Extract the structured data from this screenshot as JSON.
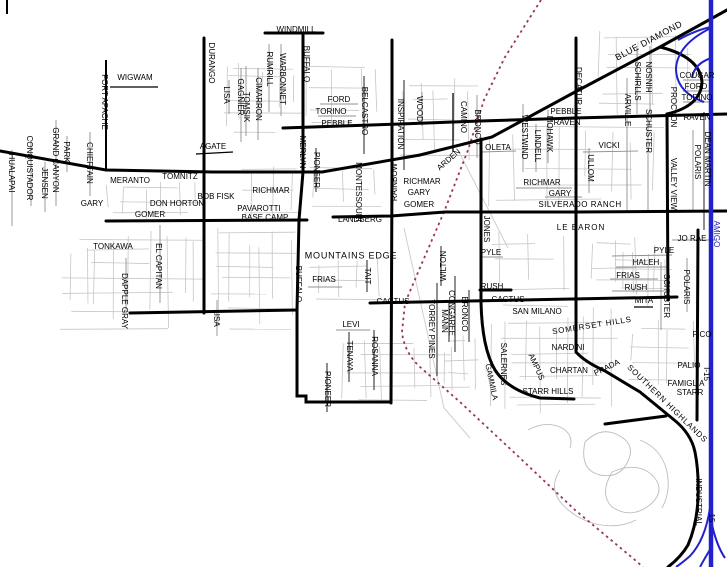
{
  "map": {
    "region": "Enterprise / Silverado Ranch, Las Vegas NV area street map",
    "colors": {
      "freeway": "#2222cc",
      "railroad": "#993366",
      "arterial": "#000000",
      "local": "#c6c6c6",
      "collector": "#909090",
      "label": "#000000",
      "freeway_label": "#2222bb"
    },
    "labels": [
      {
        "t": "HUALAPAI",
        "x": 11,
        "y": 173,
        "r": 90
      },
      {
        "t": "CONQUISTADOR",
        "x": 29,
        "y": 168,
        "r": 90
      },
      {
        "t": "JENSEN",
        "x": 44,
        "y": 183,
        "r": 90
      },
      {
        "t": "GRAND CANYON",
        "x": 55,
        "y": 160,
        "r": 90
      },
      {
        "t": "PARK",
        "x": 66,
        "y": 152,
        "r": 90
      },
      {
        "t": "CHIEFTAIN",
        "x": 89,
        "y": 163,
        "r": 90
      },
      {
        "t": "FORT APACHE",
        "x": 104,
        "y": 102,
        "r": 90
      },
      {
        "t": "WIGWAM",
        "x": 135,
        "y": 78,
        "r": 0
      },
      {
        "t": "DURANGO",
        "x": 211,
        "y": 63,
        "r": 90
      },
      {
        "t": "LISA",
        "x": 226,
        "y": 95,
        "r": 90
      },
      {
        "t": "GAGNIER",
        "x": 240,
        "y": 97,
        "r": 90
      },
      {
        "t": "AGATE",
        "x": 213,
        "y": 147,
        "r": 0
      },
      {
        "t": "MERANTO",
        "x": 130,
        "y": 181,
        "r": 0
      },
      {
        "t": "TOMNITZ",
        "x": 180,
        "y": 177,
        "r": 0
      },
      {
        "t": "GARY",
        "x": 92,
        "y": 204,
        "r": 0
      },
      {
        "t": "DON HORTON",
        "x": 177,
        "y": 204,
        "r": 0
      },
      {
        "t": "BOB FISK",
        "x": 216,
        "y": 197,
        "r": 0
      },
      {
        "t": "GOMER",
        "x": 150,
        "y": 215,
        "r": 0
      },
      {
        "t": "PAVAROTTI",
        "x": 259,
        "y": 209,
        "r": 0
      },
      {
        "t": "BASE CAMP",
        "x": 265,
        "y": 218,
        "r": 0
      },
      {
        "t": "TONKAWA",
        "x": 113,
        "y": 247,
        "r": 0
      },
      {
        "t": "EL CAPITAN",
        "x": 158,
        "y": 266,
        "r": 90
      },
      {
        "t": "DAPPLE GRAY",
        "x": 124,
        "y": 301,
        "r": 90
      },
      {
        "t": "LISA",
        "x": 216,
        "y": 318,
        "r": 90
      },
      {
        "t": "WINDMILL",
        "x": 296,
        "y": 30,
        "r": 0
      },
      {
        "t": "BUFFALO",
        "x": 306,
        "y": 64,
        "r": 90
      },
      {
        "t": "WARBONNET",
        "x": 282,
        "y": 79,
        "r": 90
      },
      {
        "t": "RUMRILL",
        "x": 269,
        "y": 69,
        "r": 90
      },
      {
        "t": "CIMARRON",
        "x": 258,
        "y": 99,
        "r": 90
      },
      {
        "t": "TOMSIK",
        "x": 246,
        "y": 107,
        "r": 90
      },
      {
        "t": "FORD",
        "x": 339,
        "y": 100,
        "r": 0
      },
      {
        "t": "TORINO",
        "x": 331,
        "y": 112,
        "r": 0
      },
      {
        "t": "PEBBLE",
        "x": 337,
        "y": 124,
        "r": 0
      },
      {
        "t": "BELCASTRO",
        "x": 364,
        "y": 111,
        "r": 90
      },
      {
        "t": "MERLYN",
        "x": 302,
        "y": 152,
        "r": 90
      },
      {
        "t": "PIONEER",
        "x": 316,
        "y": 170,
        "r": 90
      },
      {
        "t": "MONTESSOURI",
        "x": 358,
        "y": 192,
        "r": 90
      },
      {
        "t": "INSPIRATION",
        "x": 400,
        "y": 124,
        "r": 90
      },
      {
        "t": "WOOD",
        "x": 419,
        "y": 109,
        "r": 90
      },
      {
        "t": "CAMINO",
        "x": 463,
        "y": 117,
        "r": 90
      },
      {
        "t": "BRONCO",
        "x": 477,
        "y": 127,
        "r": 90
      },
      {
        "t": "ARDEN",
        "x": 449,
        "y": 160,
        "r": -41
      },
      {
        "t": "RICHMAR",
        "x": 271,
        "y": 191,
        "r": 0
      },
      {
        "t": "RICHMAR",
        "x": 422,
        "y": 182,
        "r": 0
      },
      {
        "t": "GARY",
        "x": 419,
        "y": 193,
        "r": 0
      },
      {
        "t": "GOMER",
        "x": 419,
        "y": 205,
        "r": 0
      },
      {
        "t": "RAINBOW",
        "x": 395,
        "y": 182,
        "r": -90
      },
      {
        "t": "LANDBERG",
        "x": 360,
        "y": 220,
        "r": 0
      },
      {
        "t": "MOUNTAINS EDGE",
        "x": 351,
        "y": 256,
        "r": 0,
        "fs": 9,
        "ls": 0.8
      },
      {
        "t": "BUFFALO",
        "x": 298,
        "y": 284,
        "r": 90
      },
      {
        "t": "FRIAS",
        "x": 324,
        "y": 280,
        "r": 0
      },
      {
        "t": "TAIT",
        "x": 367,
        "y": 276,
        "r": 90
      },
      {
        "t": "CACTUS",
        "x": 393,
        "y": 302,
        "r": 0
      },
      {
        "t": "LEVI",
        "x": 351,
        "y": 325,
        "r": 0
      },
      {
        "t": "TENAYA",
        "x": 349,
        "y": 356,
        "r": 90
      },
      {
        "t": "ROSANNA",
        "x": 374,
        "y": 356,
        "r": 90
      },
      {
        "t": "PIONEER",
        "x": 327,
        "y": 389,
        "r": 90
      },
      {
        "t": "BLUE DIAMOND",
        "x": 649,
        "y": 41,
        "r": -28,
        "fs": 9,
        "ls": 0.5
      },
      {
        "t": "DECATUR",
        "x": 578,
        "y": 86,
        "r": 90
      },
      {
        "t": "SCHIRLLS",
        "x": 637,
        "y": 81,
        "r": 90
      },
      {
        "t": "HINSON",
        "x": 650,
        "y": 77,
        "r": -90
      },
      {
        "t": "SCHUSTER",
        "x": 648,
        "y": 131,
        "r": 90
      },
      {
        "t": "ARVILLE",
        "x": 627,
        "y": 110,
        "r": 90
      },
      {
        "t": "PROCYON",
        "x": 673,
        "y": 107,
        "r": 90
      },
      {
        "t": "COUGAR",
        "x": 697,
        "y": 76,
        "r": 0
      },
      {
        "t": "FORD",
        "x": 696,
        "y": 87,
        "r": 0
      },
      {
        "t": "TORINO",
        "x": 697,
        "y": 98,
        "r": 0
      },
      {
        "t": "RAVEN",
        "x": 697,
        "y": 118,
        "r": 0
      },
      {
        "t": "PEBBLE",
        "x": 566,
        "y": 112,
        "r": 0
      },
      {
        "t": "RAVEN",
        "x": 567,
        "y": 123,
        "r": 0
      },
      {
        "t": "MOHAWK",
        "x": 549,
        "y": 134,
        "r": 90
      },
      {
        "t": "WESTWIND",
        "x": 524,
        "y": 137,
        "r": 90
      },
      {
        "t": "LINDELL",
        "x": 537,
        "y": 146,
        "r": 90
      },
      {
        "t": "OLETA",
        "x": 498,
        "y": 148,
        "r": 0
      },
      {
        "t": "VICKI",
        "x": 609,
        "y": 146,
        "r": 0
      },
      {
        "t": "ULLOM",
        "x": 590,
        "y": 168,
        "r": 90
      },
      {
        "t": "RICHMAR",
        "x": 542,
        "y": 183,
        "r": 0
      },
      {
        "t": "GARY",
        "x": 560,
        "y": 194,
        "r": 0
      },
      {
        "t": "SILVERADO RANCH",
        "x": 580,
        "y": 205,
        "r": 0,
        "ls": 0.5
      },
      {
        "t": "JONES",
        "x": 486,
        "y": 229,
        "r": 90
      },
      {
        "t": "LE BARON",
        "x": 581,
        "y": 228,
        "r": 0,
        "ls": 1
      },
      {
        "t": "JO RAE",
        "x": 692,
        "y": 239,
        "r": 0
      },
      {
        "t": "PYLE",
        "x": 664,
        "y": 251,
        "r": 0
      },
      {
        "t": "HALEH",
        "x": 646,
        "y": 263,
        "r": 0
      },
      {
        "t": "FRIAS",
        "x": 628,
        "y": 276,
        "r": 0
      },
      {
        "t": "RUSH",
        "x": 636,
        "y": 288,
        "r": 0
      },
      {
        "t": "MITA",
        "x": 644,
        "y": 301,
        "r": 0
      },
      {
        "t": "SCHUSTER",
        "x": 666,
        "y": 296,
        "r": 90
      },
      {
        "t": "POLARIS",
        "x": 686,
        "y": 287,
        "r": 90
      },
      {
        "t": "PYLE",
        "x": 491,
        "y": 253,
        "r": 0
      },
      {
        "t": "RUSH",
        "x": 492,
        "y": 287,
        "r": 0
      },
      {
        "t": "CACTUS",
        "x": 508,
        "y": 300,
        "r": 0
      },
      {
        "t": "SAN MILANO",
        "x": 537,
        "y": 312,
        "r": 0
      },
      {
        "t": "SOMERSET HILLS",
        "x": 592,
        "y": 326,
        "r": -9,
        "ls": 0.8
      },
      {
        "t": "FICO",
        "x": 702,
        "y": 335,
        "r": 0
      },
      {
        "t": "VALLEY VIEW",
        "x": 673,
        "y": 184,
        "r": 90
      },
      {
        "t": "DEAN MARTIN",
        "x": 707,
        "y": 159,
        "r": 90
      },
      {
        "t": "POLARIS",
        "x": 697,
        "y": 162,
        "r": 90
      },
      {
        "t": "WILTON",
        "x": 444,
        "y": 266,
        "r": -90
      },
      {
        "t": "CONGAREE",
        "x": 451,
        "y": 313,
        "r": 90
      },
      {
        "t": "MANN",
        "x": 444,
        "y": 321,
        "r": 90
      },
      {
        "t": "TORREY PINES",
        "x": 431,
        "y": 329,
        "r": 90
      },
      {
        "t": "BRONCO",
        "x": 464,
        "y": 314,
        "r": 90
      },
      {
        "t": "NARDINI",
        "x": 568,
        "y": 348,
        "r": 0
      },
      {
        "t": "CHARTAN",
        "x": 569,
        "y": 371,
        "r": 0
      },
      {
        "t": "PRADA",
        "x": 607,
        "y": 368,
        "r": -26
      },
      {
        "t": "SOUTHERN HIGHLANDS",
        "x": 667,
        "y": 404,
        "r": 44,
        "ls": 0.8
      },
      {
        "t": "FAMIGLIA",
        "x": 686,
        "y": 384,
        "r": 0
      },
      {
        "t": "STARR",
        "x": 690,
        "y": 393,
        "r": 0
      },
      {
        "t": "PALIO",
        "x": 689,
        "y": 366,
        "r": 0
      },
      {
        "t": "STARR HILLS",
        "x": 548,
        "y": 392,
        "r": 0
      },
      {
        "t": "SALERNES",
        "x": 503,
        "y": 364,
        "r": 90
      },
      {
        "t": "GAMMILA",
        "x": 491,
        "y": 382,
        "r": 78
      },
      {
        "t": "AMPUS",
        "x": 536,
        "y": 367,
        "r": 66
      },
      {
        "t": "INDUSTRIAL",
        "x": 698,
        "y": 502,
        "r": 90
      },
      {
        "t": "I-15",
        "x": 706,
        "y": 374,
        "r": 90
      },
      {
        "t": "15",
        "x": 711,
        "y": 518,
        "r": 90
      },
      {
        "t": "AMIGO",
        "x": 716,
        "y": 234,
        "r": 90,
        "c": "#2222bb"
      }
    ]
  }
}
